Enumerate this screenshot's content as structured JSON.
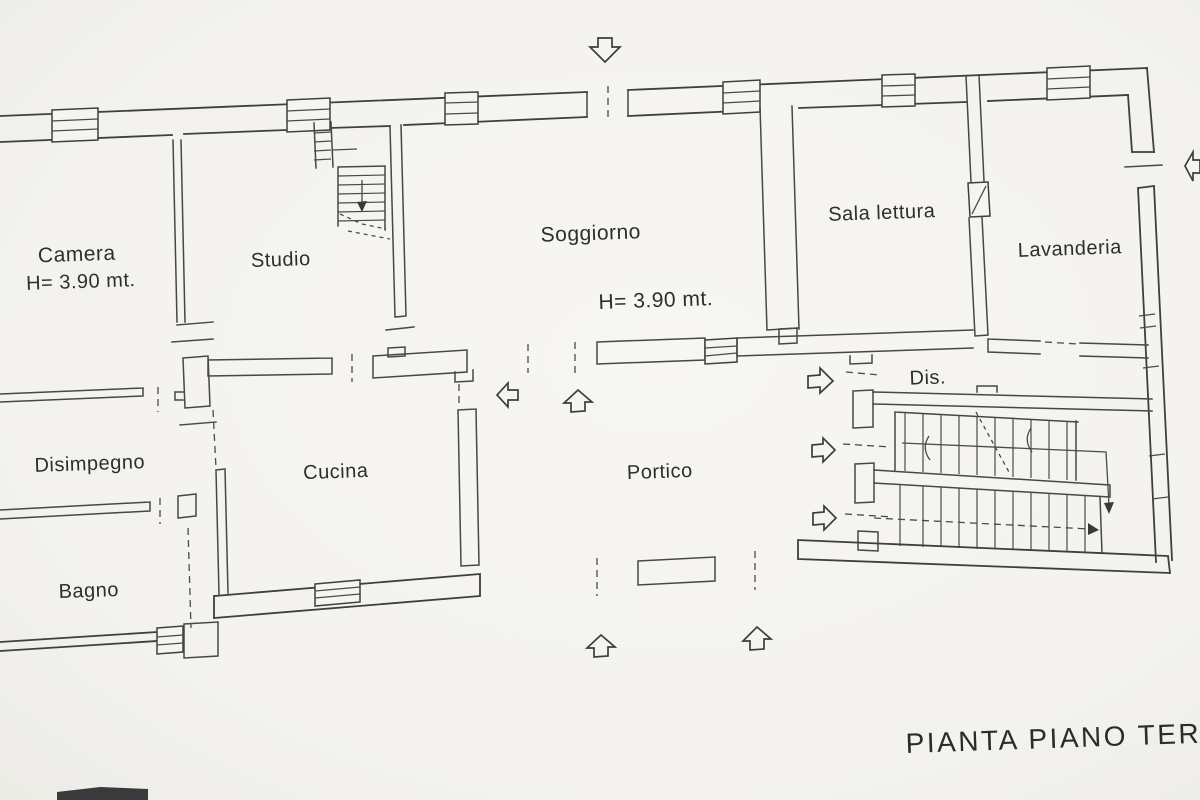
{
  "title": "PIANTA PIANO TERRA",
  "rooms": {
    "camera": {
      "name": "Camera",
      "height": "H= 3.90 mt."
    },
    "studio": {
      "name": "Studio"
    },
    "soggiorno": {
      "name": "Soggiorno",
      "height": "H= 3.90 mt."
    },
    "sala_lettura": {
      "name": "Sala lettura"
    },
    "lavanderia": {
      "name": "Lavanderia"
    },
    "dis": {
      "name": "Dis."
    },
    "disimpegno": {
      "name": "Disimpegno"
    },
    "cucina": {
      "name": "Cucina"
    },
    "portico": {
      "name": "Portico"
    },
    "bagno": {
      "name": "Bagno"
    }
  },
  "annotations": {
    "entrance_arrows": [
      {
        "id": "top-entrance",
        "direction": "down"
      },
      {
        "id": "right-entrance",
        "direction": "left"
      },
      {
        "id": "dis-corridor-door",
        "direction": "right"
      },
      {
        "id": "stair-upper-door",
        "direction": "right"
      },
      {
        "id": "stair-lower-door",
        "direction": "right"
      },
      {
        "id": "portico-west",
        "direction": "left"
      },
      {
        "id": "portico-north",
        "direction": "up"
      },
      {
        "id": "portico-south-1",
        "direction": "up"
      },
      {
        "id": "portico-south-2",
        "direction": "up"
      }
    ]
  },
  "colors": {
    "ink": "#3f3f3f",
    "paper": "#f4f3ef",
    "text": "#2e2e2e"
  }
}
